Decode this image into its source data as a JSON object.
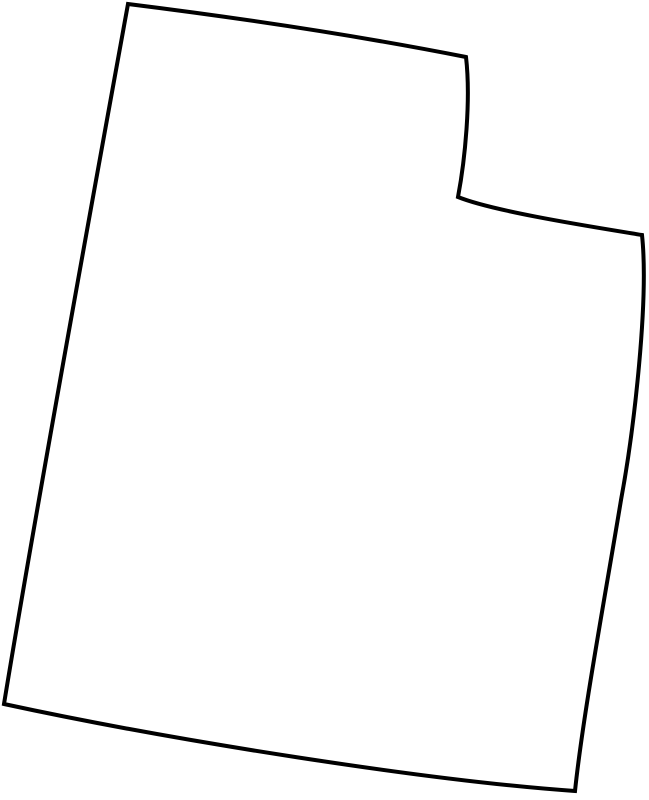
{
  "page": {
    "background_color": "#ffffff"
  },
  "map": {
    "region_name": "Utah state outline",
    "viewbox": "0 0 649 800",
    "outline_path": "M 128 4 C 240 18 360 36 466 57 C 471 100 465 160 458 197 C 495 212 600 228 642 235 C 649 300 634 430 621 500 C 605 597 583 715 575 791 C 430 781 175 741 4 704 C 34 520 96 180 128 4 Z",
    "stroke_color": "#000000",
    "fill_color": "#ffffff",
    "stroke_width": "4",
    "stroke_linejoin": "miter"
  }
}
